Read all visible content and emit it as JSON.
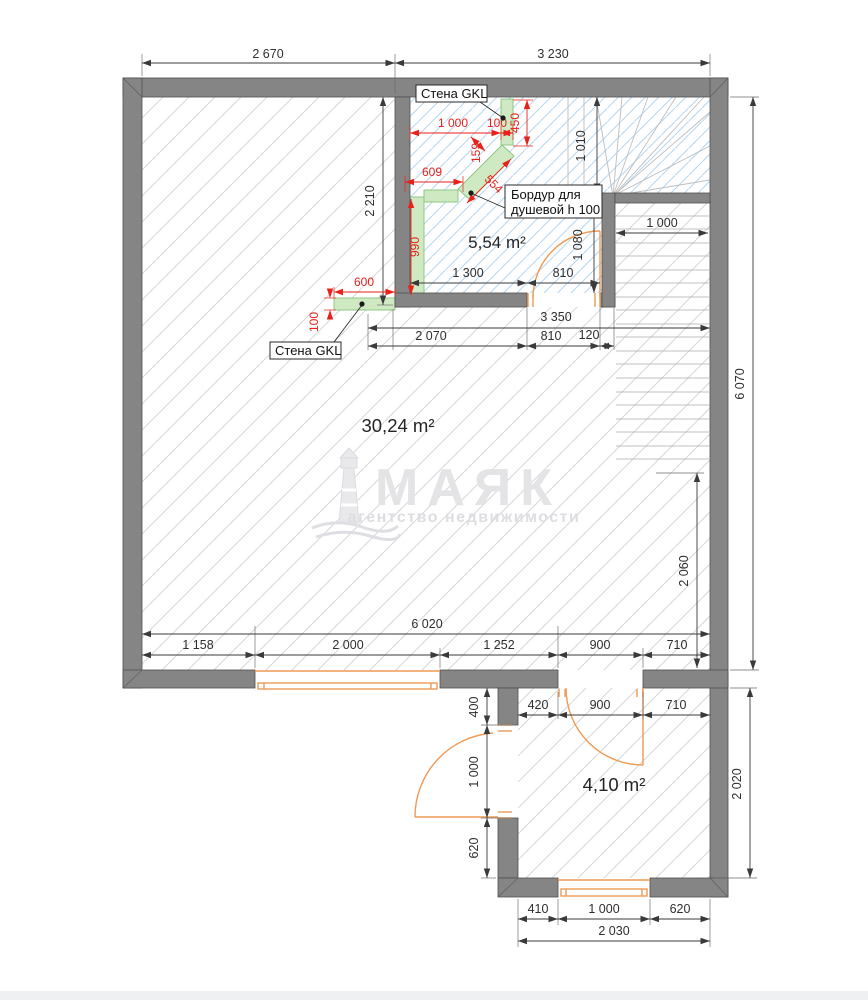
{
  "watermark": {
    "brand": "МАЯК",
    "tagline": "агентство недвижимости"
  },
  "rooms": {
    "living": "30,24 m²",
    "bathroom": "5,54 m²",
    "hall": "4,10 m²"
  },
  "labels": {
    "wall_gkl_top": "Стена GKL",
    "wall_gkl_left": "Стена GKL",
    "shower_note_1": "Бордур для",
    "shower_note_2": "душевой h 100"
  },
  "dims": {
    "top_left": "2 670",
    "top_right": "3 230",
    "bath_left_h": "2 210",
    "winder_h": "1 010",
    "bath_right_h": "1 080",
    "stair_w": "1 000",
    "bath_w": "1 300",
    "bath_door": "810",
    "mid_total": "3 350",
    "mid_a": "2 070",
    "mid_b": "810",
    "mid_c": "120",
    "right_h": "6 070",
    "living_right_h": "2 060",
    "bottom_total": "6 020",
    "bottom_a": "1 158",
    "bottom_b": "2 000",
    "bottom_c": "1 252",
    "bottom_d": "900",
    "bottom_e": "710",
    "hall_right_h": "2 020",
    "hall_a": "420",
    "hall_b": "900",
    "hall_c": "710",
    "hall_left_a": "400",
    "hall_left_b": "1 000",
    "hall_left_c": "620",
    "hall_bot_a": "410",
    "hall_bot_b": "1 000",
    "hall_bot_c": "620",
    "hall_bot_total": "2 030"
  },
  "dims_red": {
    "shower_top_w": "1 000",
    "gkl_stub_w": "100",
    "gkl_stub_len": "450",
    "border_w": "159",
    "border_len": "554",
    "shower_side": "609",
    "shower_strip_h": "990",
    "gkl_wall_len": "600",
    "gkl_wall_w": "100"
  },
  "colors": {
    "wall": "#858585",
    "wall_edge": "#4f4f4f",
    "hatch_gray": "#d8d8d8",
    "hatch_blue": "#b5d6f0",
    "green_fill": "#cfeac3",
    "green_edge": "#84c47c",
    "dim_red": "#e8211a",
    "dim_black": "#2e2e2e",
    "joinery_orange": "#ee9a55",
    "watermark_gray": "#e4e4e7"
  }
}
